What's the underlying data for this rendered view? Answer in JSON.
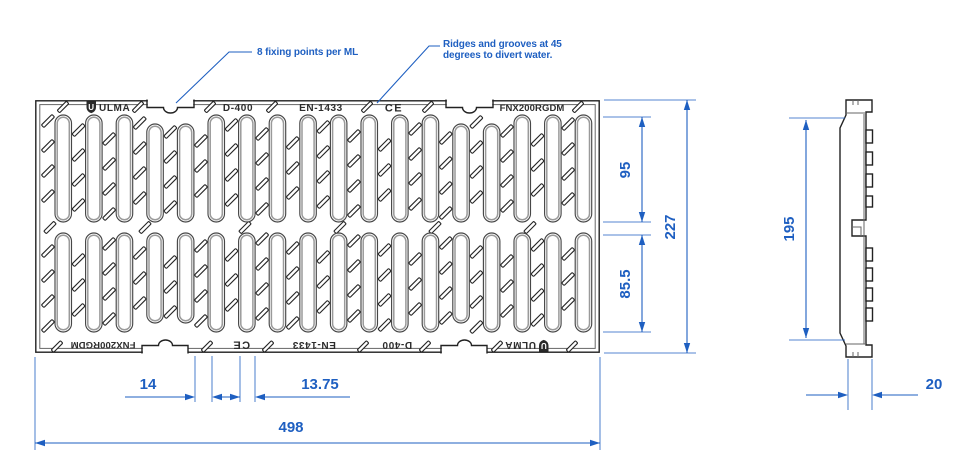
{
  "annotations": {
    "fixing": "8 fixing points per ML",
    "ridges_line1": "Ridges and grooves at 45",
    "ridges_line2": "degrees to divert water."
  },
  "markings": {
    "brand": "ULMA",
    "brand_initial": "U",
    "load_class": "D-400",
    "standard": "EN-1433",
    "ce_mark": "CE",
    "model": "FNX200RGDM"
  },
  "dimensions": {
    "top_slot_length": "95",
    "overall_height": "227",
    "bottom_slot_length": "85.5",
    "side_height": "195",
    "slot_width": "14",
    "rib_width": "13.75",
    "overall_length": "498",
    "thickness": "20"
  },
  "colors": {
    "dim_blue": "#1e5fc1",
    "line": "#222222"
  }
}
